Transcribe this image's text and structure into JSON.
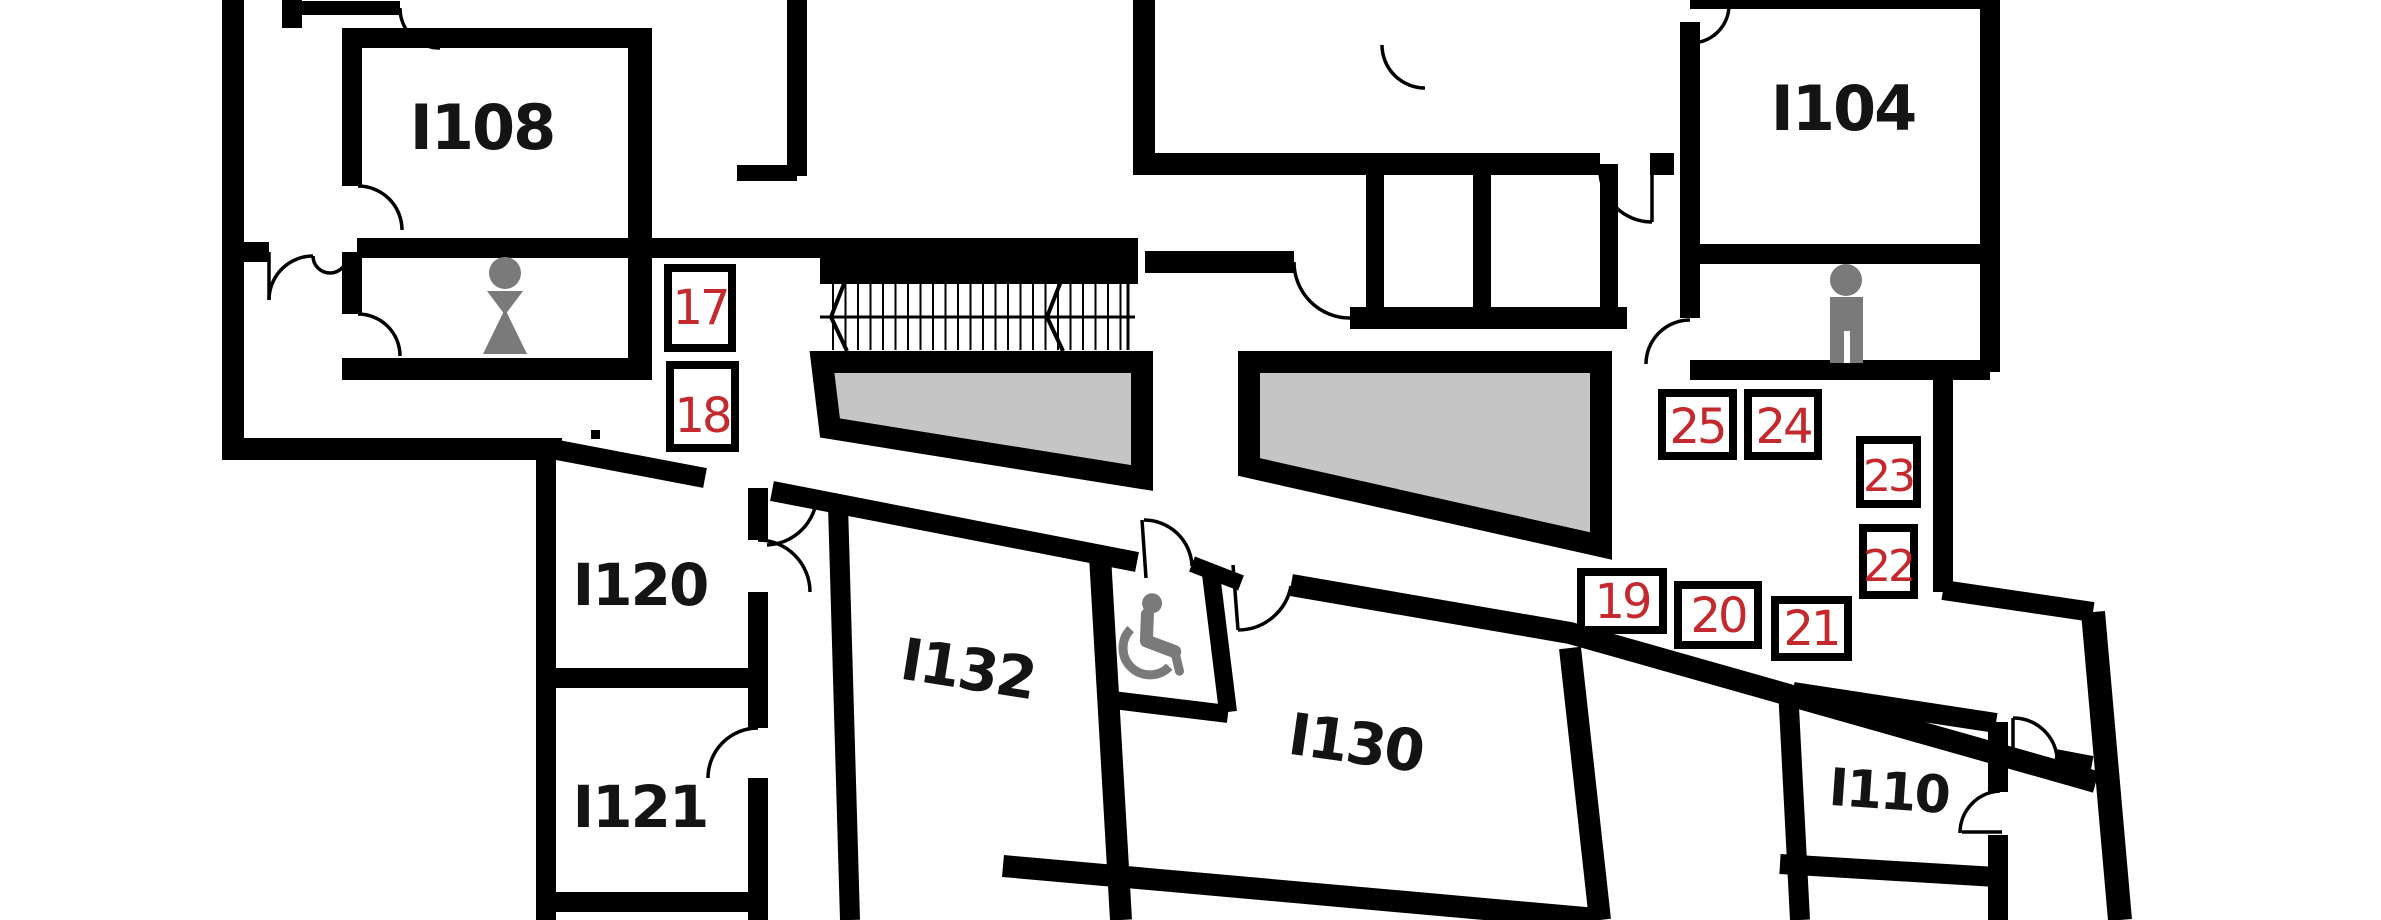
{
  "plan": {
    "rooms": [
      {
        "label": "I108"
      },
      {
        "label": "I104"
      },
      {
        "label": "I120"
      },
      {
        "label": "I121"
      },
      {
        "label": "I132"
      },
      {
        "label": "I130"
      },
      {
        "label": "I110"
      }
    ],
    "markers": [
      {
        "label": "17"
      },
      {
        "label": "18"
      },
      {
        "label": "19"
      },
      {
        "label": "20"
      },
      {
        "label": "21"
      },
      {
        "label": "22"
      },
      {
        "label": "23"
      },
      {
        "label": "24"
      },
      {
        "label": "25"
      }
    ],
    "icons": [
      {
        "name": "female-restroom-icon"
      },
      {
        "name": "male-restroom-icon"
      },
      {
        "name": "wheelchair-accessible-icon"
      }
    ],
    "colors": {
      "wall": "#000000",
      "background": "#ffffff",
      "shaded_area": "#c5c5c5",
      "icon_gray": "#7a7a7a",
      "marker_number": "#c4292e",
      "room_label": "#141414"
    },
    "features": {
      "stairs": 1,
      "shaded_ramp_areas": 2,
      "door_swings": true
    }
  }
}
